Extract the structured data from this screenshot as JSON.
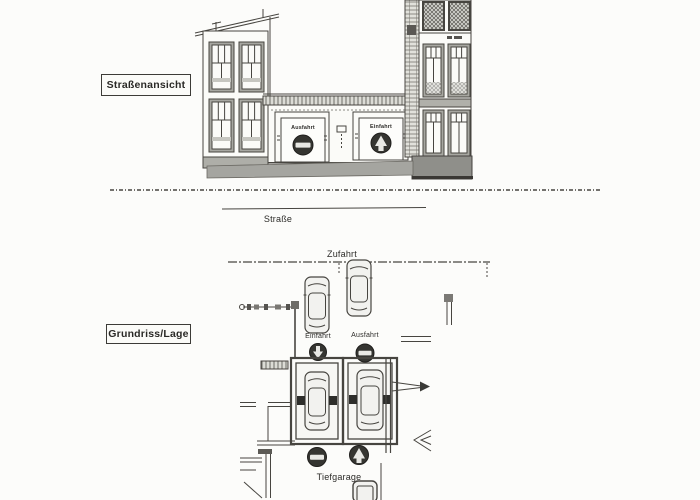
{
  "elevation": {
    "title": "Straßenansicht",
    "garage_doors": [
      {
        "label": "Ausfahrt",
        "sign_icon": "no-entry-sign"
      },
      {
        "label": "Einfahrt",
        "sign_icon": "arrow-up-sign"
      }
    ]
  },
  "street": {
    "label": "Straße"
  },
  "plan": {
    "title": "Grundriss/Lage",
    "approach_label": "Zufahrt",
    "entry": {
      "label": "Einfahrt",
      "sign_icon": "arrow-down-sign"
    },
    "exit": {
      "label": "Ausfahrt",
      "sign_icon": "no-entry-sign"
    },
    "garage_signs": [
      {
        "sign_icon": "no-entry-sign"
      },
      {
        "sign_icon": "arrow-up-sign"
      }
    ],
    "underground_label": "Tiefgarage"
  },
  "colors": {
    "paper": "#fcfcfa",
    "ink": "#474540",
    "frame_gray": "#a7a7a1",
    "ground_gray": "#a5a5a0",
    "base_gray": "#8f8f8a",
    "sign_dark": "#353531"
  }
}
